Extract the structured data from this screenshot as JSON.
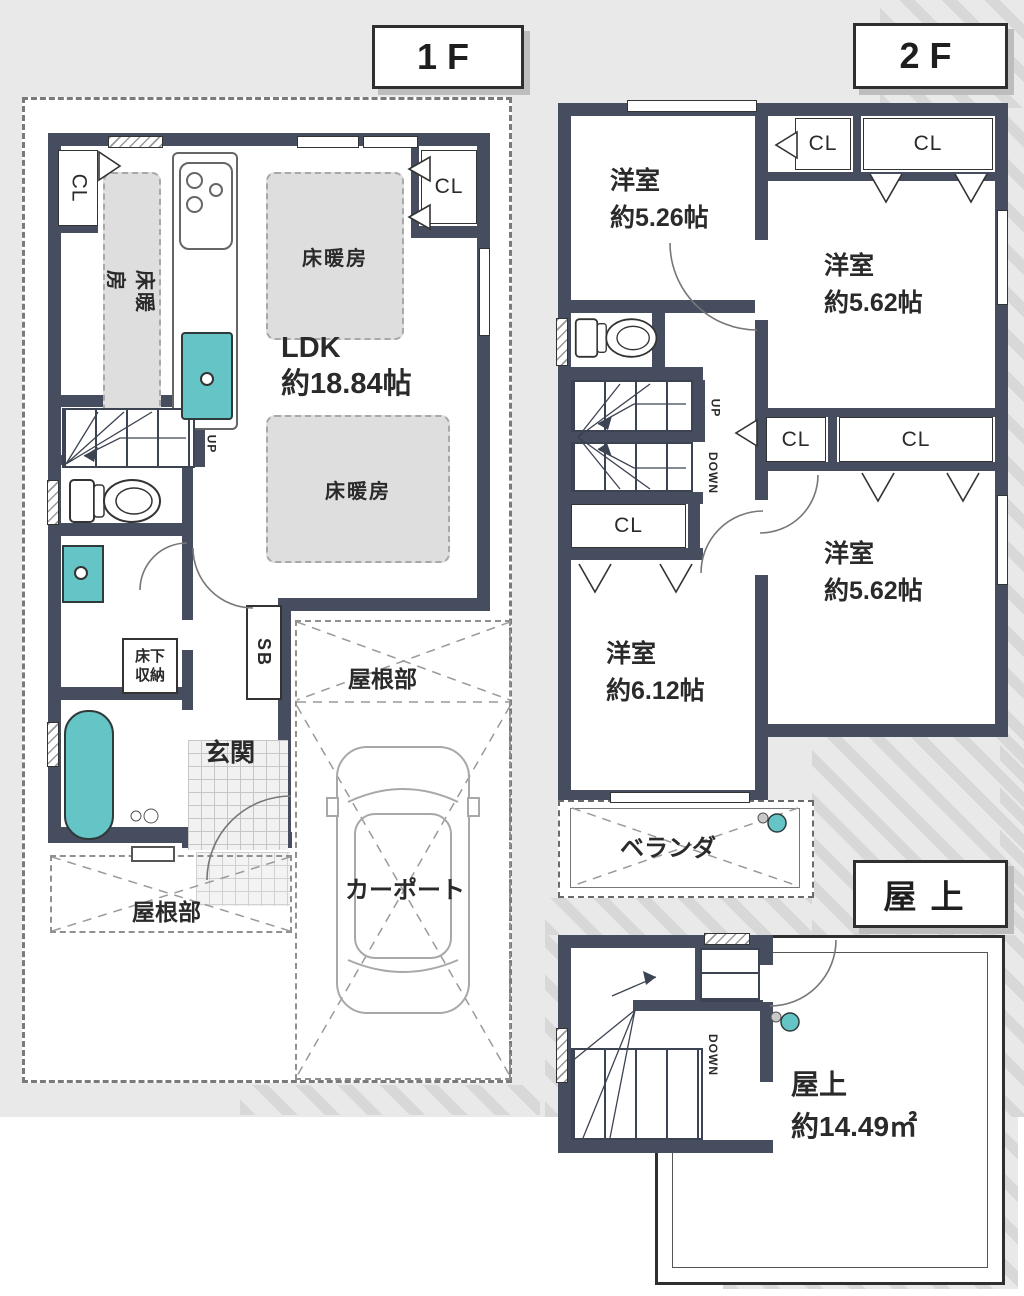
{
  "f1": {
    "title": "1F",
    "ldk_name": "LDK",
    "ldk_size": "約18.84帖",
    "floor_heating": "床暖房",
    "cl": "CL",
    "up": "UP",
    "sb": "SB",
    "underfloor_line1": "床下",
    "underfloor_line2": "収納",
    "entrance": "玄関",
    "roof_part": "屋根部",
    "carport": "カーポート"
  },
  "f2": {
    "title": "2F",
    "cl": "CL",
    "up": "UP",
    "down": "DOWN",
    "veranda": "ベランダ",
    "rooms": [
      {
        "name": "洋室",
        "size": "約5.26帖"
      },
      {
        "name": "洋室",
        "size": "約5.62帖"
      },
      {
        "name": "洋室",
        "size": "約5.62帖"
      },
      {
        "name": "洋室",
        "size": "約6.12帖"
      }
    ]
  },
  "roof": {
    "title": "屋上",
    "down": "DOWN",
    "area_name": "屋上",
    "area_size": "約14.49㎡"
  },
  "colors": {
    "wall": "#454d5f",
    "fixture_teal": "#65c4c6",
    "floor_heating_fill": "#dedede",
    "background": "#e9e9e9"
  }
}
